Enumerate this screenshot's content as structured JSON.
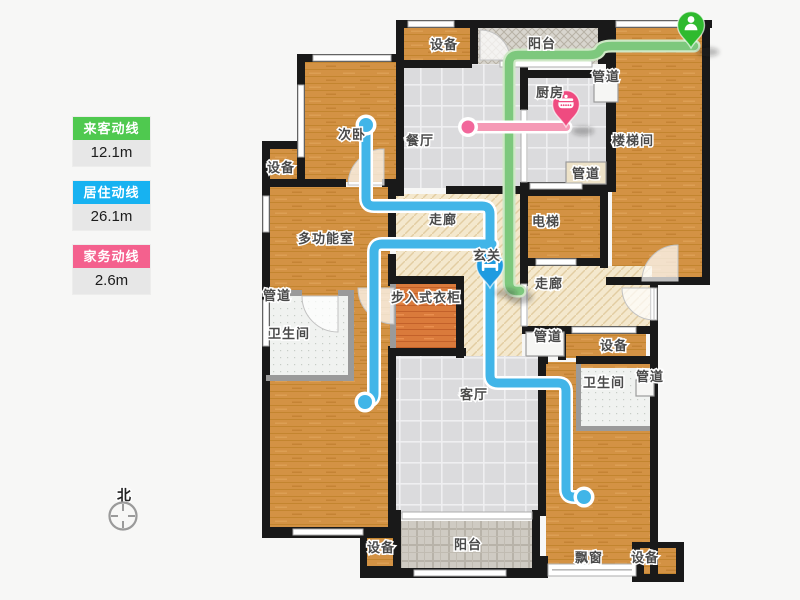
{
  "title": "户型图动线示意",
  "legend": {
    "items": [
      {
        "label": "来客动线",
        "value": "12.1m",
        "color": "#4fc94f"
      },
      {
        "label": "居住动线",
        "value": "26.1m",
        "color": "#17b2f1"
      },
      {
        "label": "家务动线",
        "value": "2.6m",
        "color": "#f4618e"
      }
    ]
  },
  "compass": {
    "label": "北"
  },
  "rooms": [
    {
      "id": "equipment-top",
      "label": "设备"
    },
    {
      "id": "balcony-top",
      "label": "阳台"
    },
    {
      "id": "pipe-top",
      "label": "管道"
    },
    {
      "id": "kitchen",
      "label": "厨房"
    },
    {
      "id": "stairwell",
      "label": "楼梯间"
    },
    {
      "id": "second-bedroom",
      "label": "次卧"
    },
    {
      "id": "dining-room",
      "label": "餐厅"
    },
    {
      "id": "equipment-left",
      "label": "设备"
    },
    {
      "id": "multi-function",
      "label": "多功能室"
    },
    {
      "id": "corridor-upper",
      "label": "走廊"
    },
    {
      "id": "elevator",
      "label": "电梯"
    },
    {
      "id": "foyer",
      "label": "玄关"
    },
    {
      "id": "corridor-right",
      "label": "走廊"
    },
    {
      "id": "pipe-bath-left",
      "label": "管道"
    },
    {
      "id": "bathroom-left",
      "label": "卫生间"
    },
    {
      "id": "walkin-closet",
      "label": "步入式衣柜"
    },
    {
      "id": "pipe-middle",
      "label": "管道"
    },
    {
      "id": "equipment-middle",
      "label": "设备"
    },
    {
      "id": "bathroom-right",
      "label": "卫生间"
    },
    {
      "id": "pipe-right",
      "label": "管道"
    },
    {
      "id": "living-room",
      "label": "客厅"
    },
    {
      "id": "equipment-bottom-left",
      "label": "设备"
    },
    {
      "id": "balcony-bottom",
      "label": "阳台"
    },
    {
      "id": "bay-window",
      "label": "飘窗"
    },
    {
      "id": "equipment-bottom-right",
      "label": "设备"
    },
    {
      "id": "pipe-kitchen",
      "label": "管道"
    }
  ],
  "pins": [
    {
      "id": "visitor-pin",
      "icon": "person-icon",
      "color": "#2fba2f",
      "route": "来客动线"
    },
    {
      "id": "kitchen-pin",
      "icon": "pot-icon",
      "color": "#ef4b80",
      "route": "家务动线"
    },
    {
      "id": "entry-pin",
      "icon": "bed-icon",
      "color": "#1f9be0",
      "route": "居住动线"
    }
  ]
}
